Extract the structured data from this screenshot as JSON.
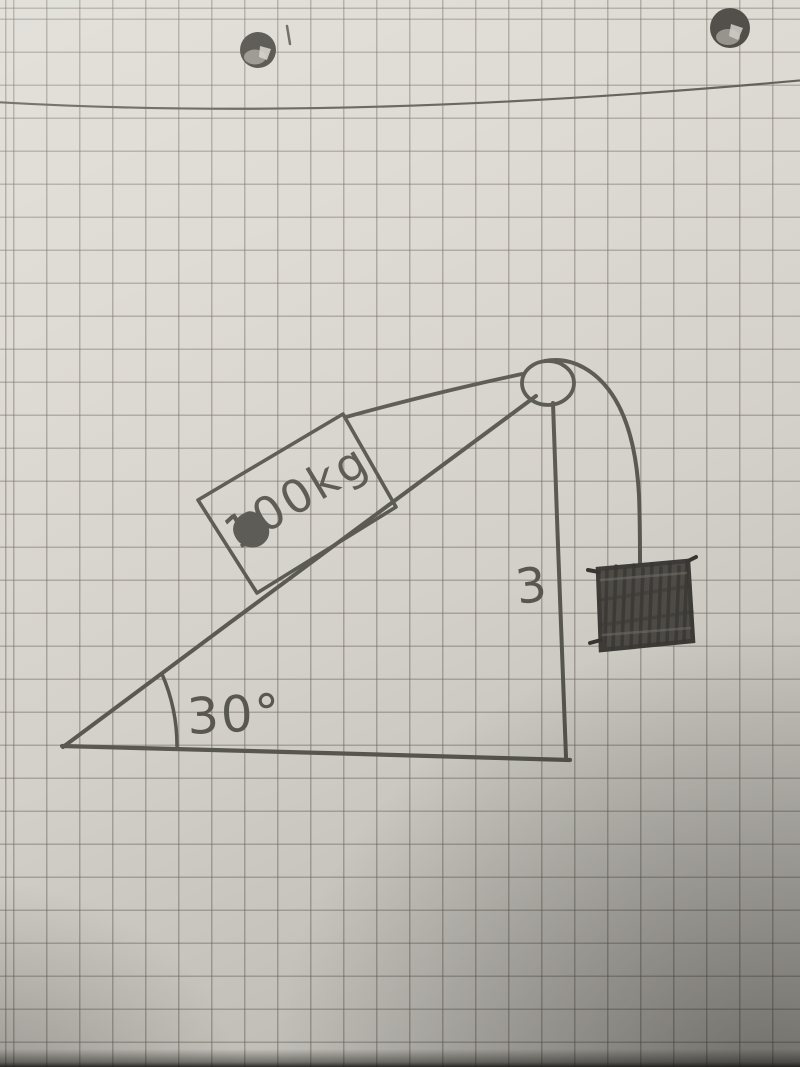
{
  "labels": {
    "block_mass": "100kg",
    "incline_angle": "30°",
    "vertical_side_length": "3"
  },
  "diagram_elements": {
    "surface": "inclined-plane-right-triangle",
    "block_on_incline": "rectangle labeled 100kg",
    "pulley": "circle at top of incline",
    "rope": "from block over pulley to hanging mass",
    "hanging_mass": "shaded scribbled box",
    "angle_arc": "arc at lower-left vertex marked 30°",
    "vertical_side": "right side of triangle marked 3"
  },
  "colors": {
    "paper": "#dcd9d2",
    "grid_line": "#6e6961",
    "pencil": "#5d5b55",
    "mass_fill": "#53504b",
    "mass_hatch": "#3b3935",
    "hole_dark": "#47443f",
    "hole_light": "#908d86",
    "hole_bright": "#cfccc5"
  }
}
